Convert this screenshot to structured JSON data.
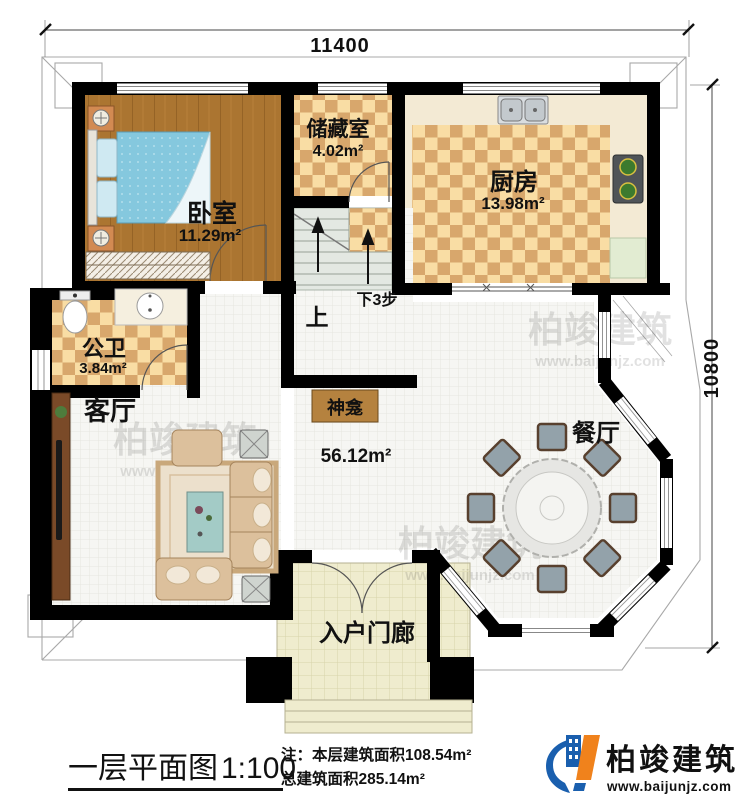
{
  "canvas": {
    "width": 750,
    "height": 801
  },
  "dimensions": {
    "width_label": "11400",
    "height_label": "10800"
  },
  "rooms": {
    "bedroom": {
      "name": "卧室",
      "area": "11.29m²"
    },
    "storage": {
      "name": "储藏室",
      "area": "4.02m²"
    },
    "kitchen": {
      "name": "厨房",
      "area": "13.98m²"
    },
    "bathroom": {
      "name": "公卫",
      "area": "3.84m²"
    },
    "living": {
      "name": "客厅",
      "area": "56.12m²"
    },
    "dining": {
      "name": "餐厅"
    },
    "porch": {
      "name": "入户门廊"
    },
    "shrine": {
      "name": "神龛"
    }
  },
  "stairs": {
    "up": "上",
    "down": "下3步"
  },
  "footer": {
    "title": "一层平面图",
    "scale": "1:100",
    "note_line1": "注：本层建筑面积108.54m²",
    "note_line2": "总建筑面积285.14m²"
  },
  "brand": {
    "name": "柏竣建筑",
    "website": "www.baijunjz.com"
  },
  "watermark": {
    "name": "柏竣建筑",
    "website": "www.baijunjz.com"
  },
  "colors": {
    "wall": "#000000",
    "wood_floor": "#ab7531",
    "checker_light": "#f9dda4",
    "checker_dark": "#d8a76c",
    "bed": "#85c8de",
    "tile": "#f6f6f3",
    "porch": "#efecce",
    "stair": "#e3e8e2",
    "brand_blue": "#1a5fae",
    "brand_orange": "#f0821c"
  }
}
